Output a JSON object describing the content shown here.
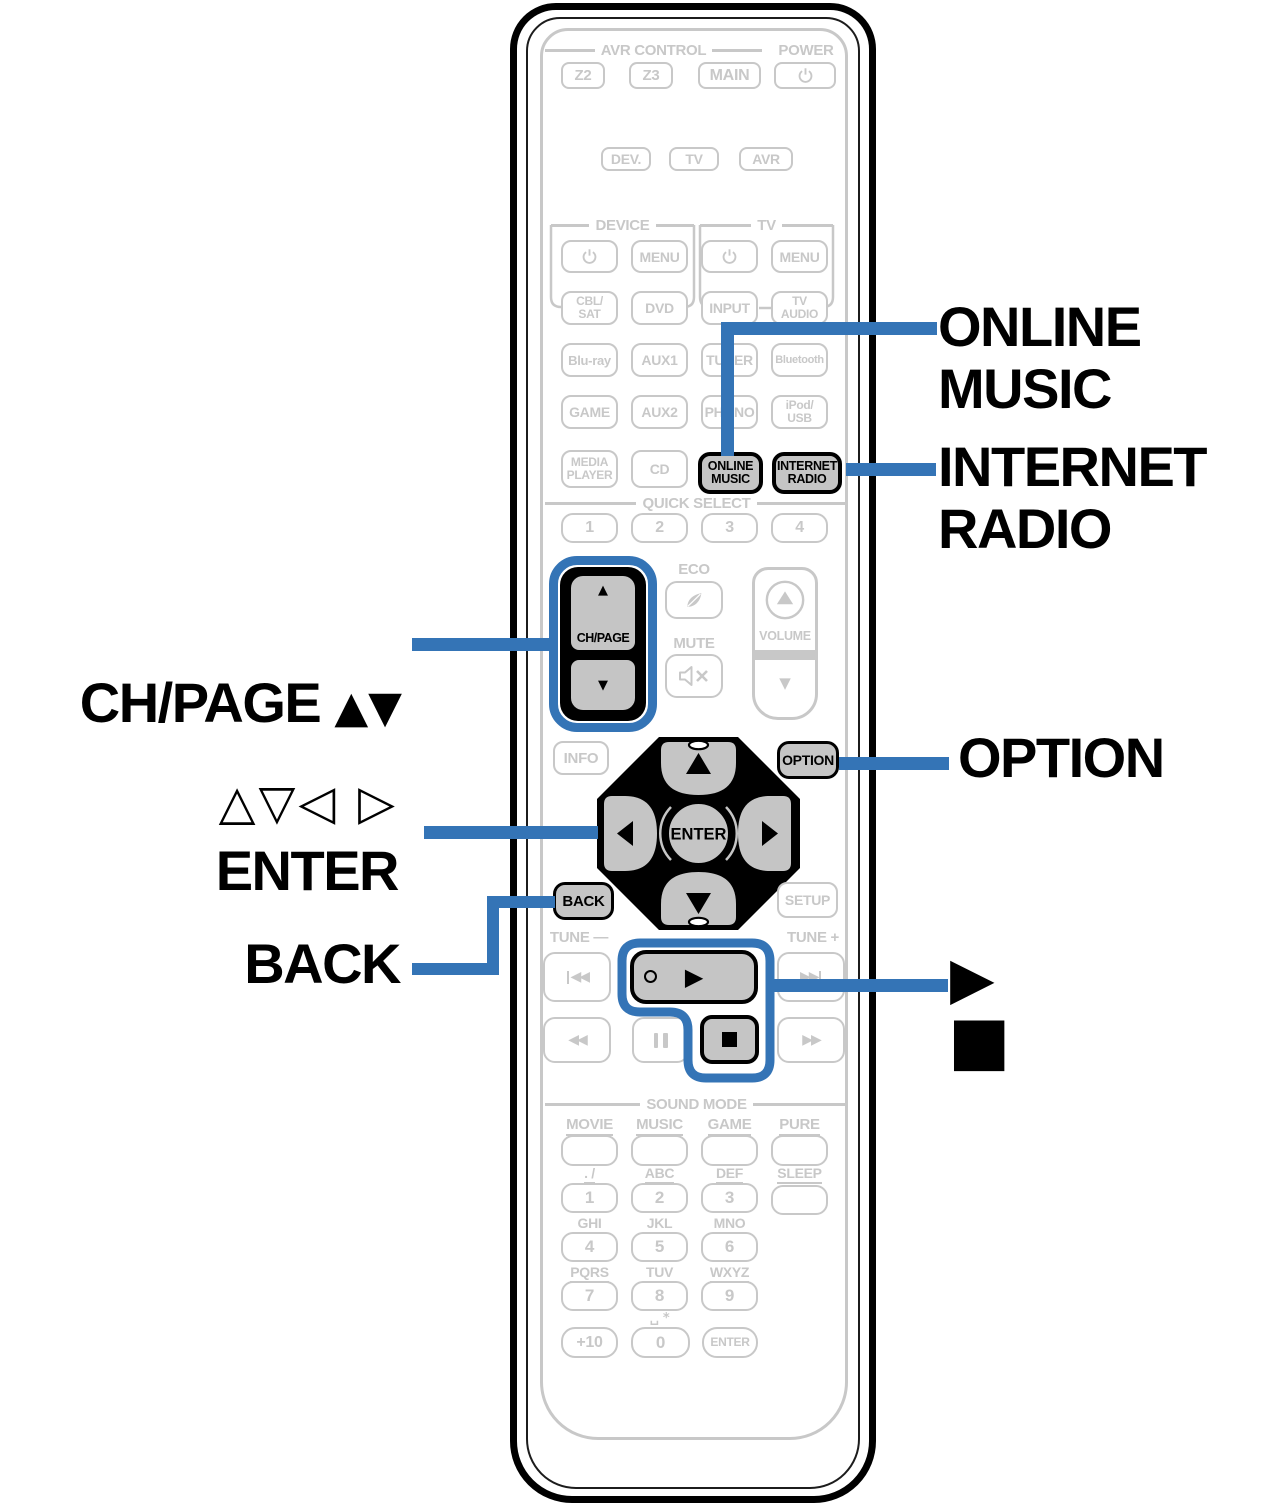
{
  "colors": {
    "accent": "#3474b6",
    "gray": "#c8c8c8",
    "button_fill": "#c5c5c5"
  },
  "headers": {
    "avr_control": "AVR CONTROL",
    "power": "POWER",
    "device": "DEVICE",
    "tv": "TV",
    "quick_select": "QUICK SELECT",
    "sound_mode": "SOUND MODE"
  },
  "buttons": {
    "z2": "Z2",
    "z3": "Z3",
    "main": "MAIN",
    "dev": "DEV.",
    "tv": "TV",
    "avr": "AVR",
    "menu": "MENU",
    "cbl_sat": "CBL/\nSAT",
    "dvd": "DVD",
    "input": "INPUT",
    "tv_audio": "TV\nAUDIO",
    "bluray": "Blu-ray",
    "aux1": "AUX1",
    "tuner": "TUNER",
    "bluetooth": "Bluetooth",
    "game": "GAME",
    "aux2": "AUX2",
    "phono": "PHONO",
    "ipod_usb": "iPod/\nUSB",
    "media_player": "MEDIA\nPLAYER",
    "cd": "CD",
    "online_music": "ONLINE\nMUSIC",
    "internet_radio": "INTERNET\nRADIO",
    "qs1": "1",
    "qs2": "2",
    "qs3": "3",
    "qs4": "4",
    "ch_page": "CH/PAGE",
    "up": "▲",
    "down": "▼",
    "eco": "ECO",
    "mute": "MUTE",
    "volume": "VOLUME",
    "info": "INFO",
    "option": "OPTION",
    "enter": "ENTER",
    "back": "BACK",
    "setup": "SETUP",
    "tune_down": "TUNE —",
    "tune_up": "TUNE +",
    "skip_back": "◀◀",
    "skip_fwd": "▶▶",
    "rew": "◀◀",
    "ff": "▶▶",
    "play": "▶",
    "movie": "MOVIE",
    "music": "MUSIC",
    "game_mode": "GAME",
    "pure": "PURE",
    "sleep": "SLEEP",
    "n1": "1",
    "n2": "2",
    "n3": "3",
    "n4": "4",
    "n5": "5",
    "n6": "6",
    "n7": "7",
    "n8": "8",
    "n9": "9",
    "n0": "0",
    "plus10": "+10",
    "num_enter": "ENTER",
    "l1": ". /",
    "l2": "ABC",
    "l3": "DEF",
    "l4": "GHI",
    "l5": "JKL",
    "l6": "MNO",
    "l7": "PQRS",
    "l8": "TUV",
    "l9": "WXYZ",
    "l0": "␣ *"
  },
  "callouts": {
    "online_music": "ONLINE\nMUSIC",
    "internet_radio": "INTERNET\nRADIO",
    "chpage_text": "CH/PAGE ",
    "chpage_arrows": "▲▼",
    "cursor_arrows": "△▽◁ ▷",
    "enter": "ENTER",
    "back": "BACK",
    "option": "OPTION",
    "play": "▶",
    "stop": "■"
  }
}
